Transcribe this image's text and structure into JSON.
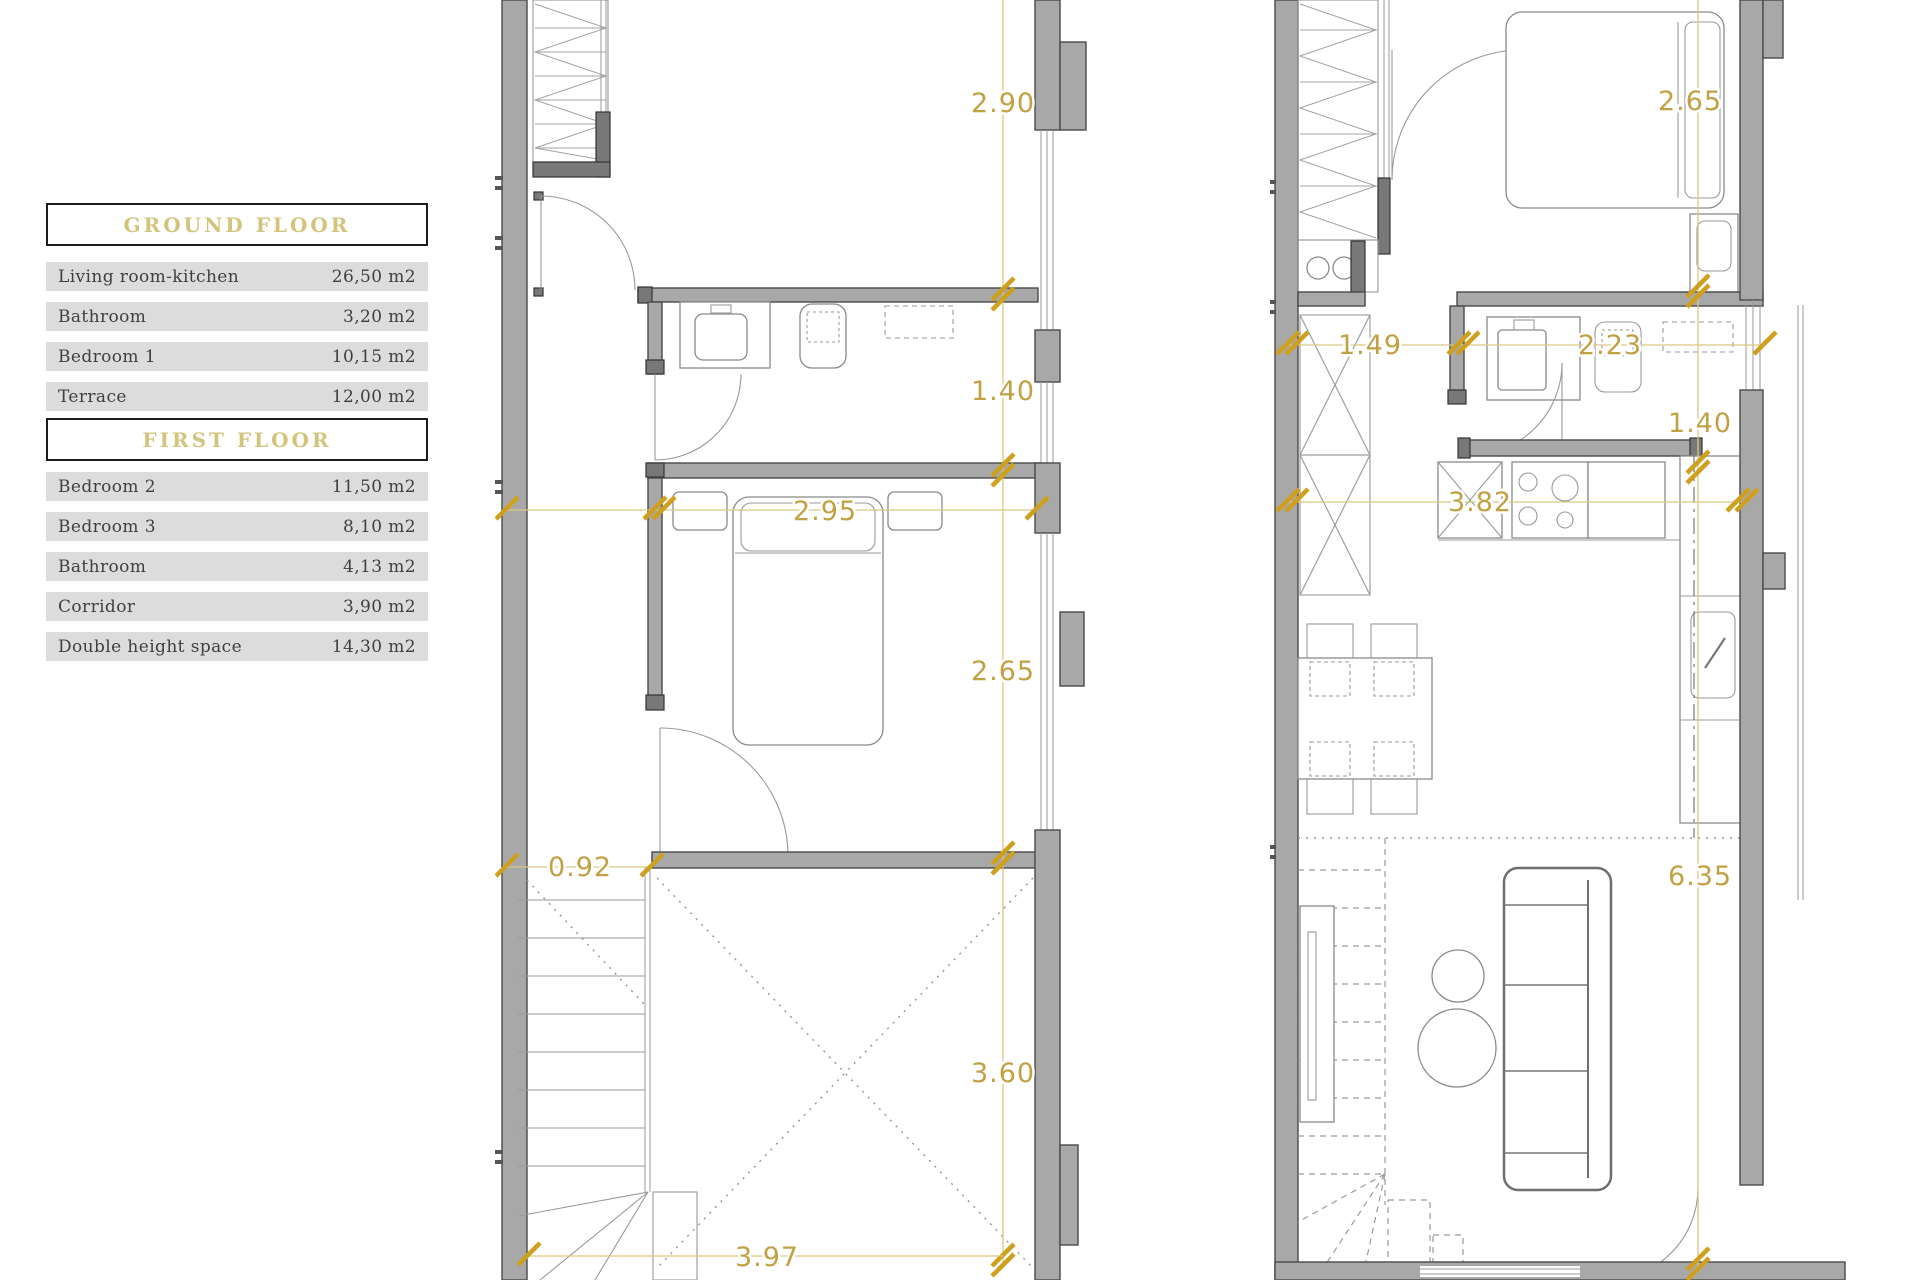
{
  "colors": {
    "accent_gold": "#c2a144",
    "tick_gold": "#cf9f1e",
    "wall_gray": "#a8a8a8",
    "wall_dark": "#787878",
    "legend_row_bg": "#dcdcdc",
    "legend_title_gold": "#d3c47c",
    "text_dark": "#3f3f3f"
  },
  "legend": {
    "ground_floor": {
      "title": "GROUND FLOOR",
      "rows": [
        {
          "label": "Living room-kitchen",
          "area": "26,50 m2"
        },
        {
          "label": "Bathroom",
          "area": "3,20 m2"
        },
        {
          "label": "Bedroom 1",
          "area": "10,15 m2"
        },
        {
          "label": "Terrace",
          "area": "12,00 m2"
        }
      ]
    },
    "first_floor": {
      "title": "FIRST FLOOR",
      "rows": [
        {
          "label": "Bedroom 2",
          "area": "11,50 m2"
        },
        {
          "label": "Bedroom 3",
          "area": "8,10 m2"
        },
        {
          "label": "Bathroom",
          "area": "4,13 m2"
        },
        {
          "label": "Corridor",
          "area": "3,90 m2"
        },
        {
          "label": "Double height space",
          "area": "14,30 m2"
        }
      ]
    }
  },
  "plans": {
    "first_floor": {
      "name": "first floor plan",
      "dims": {
        "room_height_top": "2.90",
        "bath_height": "1.40",
        "bedroom_width": "2.95",
        "bedroom_height": "2.65",
        "door_width": "0.92",
        "void_height": "3.60",
        "void_width": "3.97"
      }
    },
    "ground_floor": {
      "name": "ground floor plan",
      "dims": {
        "bedroom_height": "2.65",
        "hall_width": "1.49",
        "bath_width": "2.23",
        "bath_height": "1.40",
        "kitchen_width": "3.82",
        "living_height": "6.35"
      }
    }
  }
}
